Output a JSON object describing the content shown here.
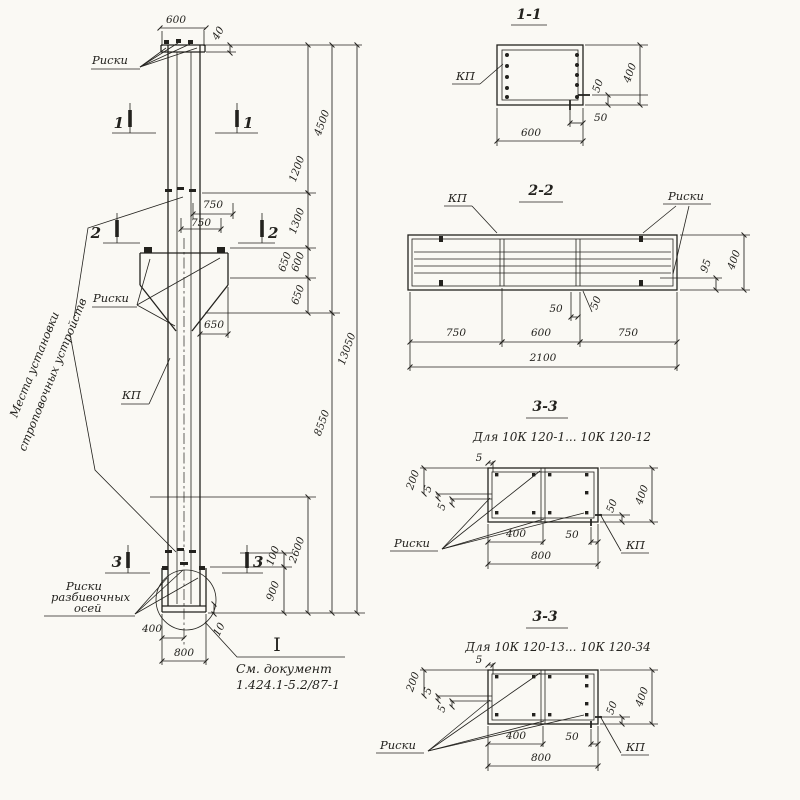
{
  "main_view": {
    "labels": {
      "riski_top": "Риски",
      "riski_console": "Риски",
      "kp": "КП",
      "sling_note_line1": "Места установки",
      "sling_note_line2": "строповочных устройств",
      "axis_note_line1": "Риски",
      "axis_note_line2": "разбивочных",
      "axis_note_line3": "осей",
      "doc_note_line1": "См. документ",
      "doc_note_line2": "1.424.1-5.2/87-1",
      "detail_mark": "I"
    },
    "section_marks": {
      "s1": "1",
      "s2": "2",
      "s3": "3"
    },
    "dims": {
      "head_width": "600",
      "head_offset": "40",
      "sling_a": "750",
      "sling_b": "750",
      "console_reach": "650",
      "seg_a": "1200",
      "seg_b": "1300",
      "seg_c1": "650",
      "seg_c2": "600",
      "seg_d": "650",
      "upper_total": "4500",
      "lower_total": "8550",
      "overall_length": "13050",
      "tip_sling": "2600",
      "tip_a": "100",
      "tip_b": "900",
      "base_half": "400",
      "base_width": "800",
      "plate_t": "10"
    }
  },
  "section_1_1": {
    "title": "1-1",
    "kp": "КП",
    "dims": {
      "width": "600",
      "height": "400",
      "off_h": "50",
      "off_v": "50"
    }
  },
  "section_2_2": {
    "title": "2-2",
    "kp": "КП",
    "riski": "Риски",
    "dims": {
      "seg_a": "750",
      "seg_b": "600",
      "seg_c": "750",
      "total": "2100",
      "off_a": "50",
      "off_b": "50",
      "edge": "95",
      "height": "400"
    }
  },
  "section_3_3_a": {
    "title": "3-3",
    "subtitle": "Для 10К 120-1... 10К 120-12",
    "riski": "Риски",
    "kp": "КП",
    "dims": {
      "top": "200",
      "m5a": "5",
      "m5b": "5",
      "m5t": "5",
      "off": "50",
      "height": "400",
      "half": "400",
      "off_b": "50",
      "width": "800"
    }
  },
  "section_3_3_b": {
    "title": "3-3",
    "subtitle": "Для 10К 120-13... 10К 120-34",
    "riski": "Риски",
    "kp": "КП",
    "dims": {
      "top": "200",
      "m5a": "5",
      "m5b": "5",
      "m5t": "5",
      "off": "50",
      "height": "400",
      "half": "400",
      "off_b": "50",
      "width": "800"
    }
  }
}
